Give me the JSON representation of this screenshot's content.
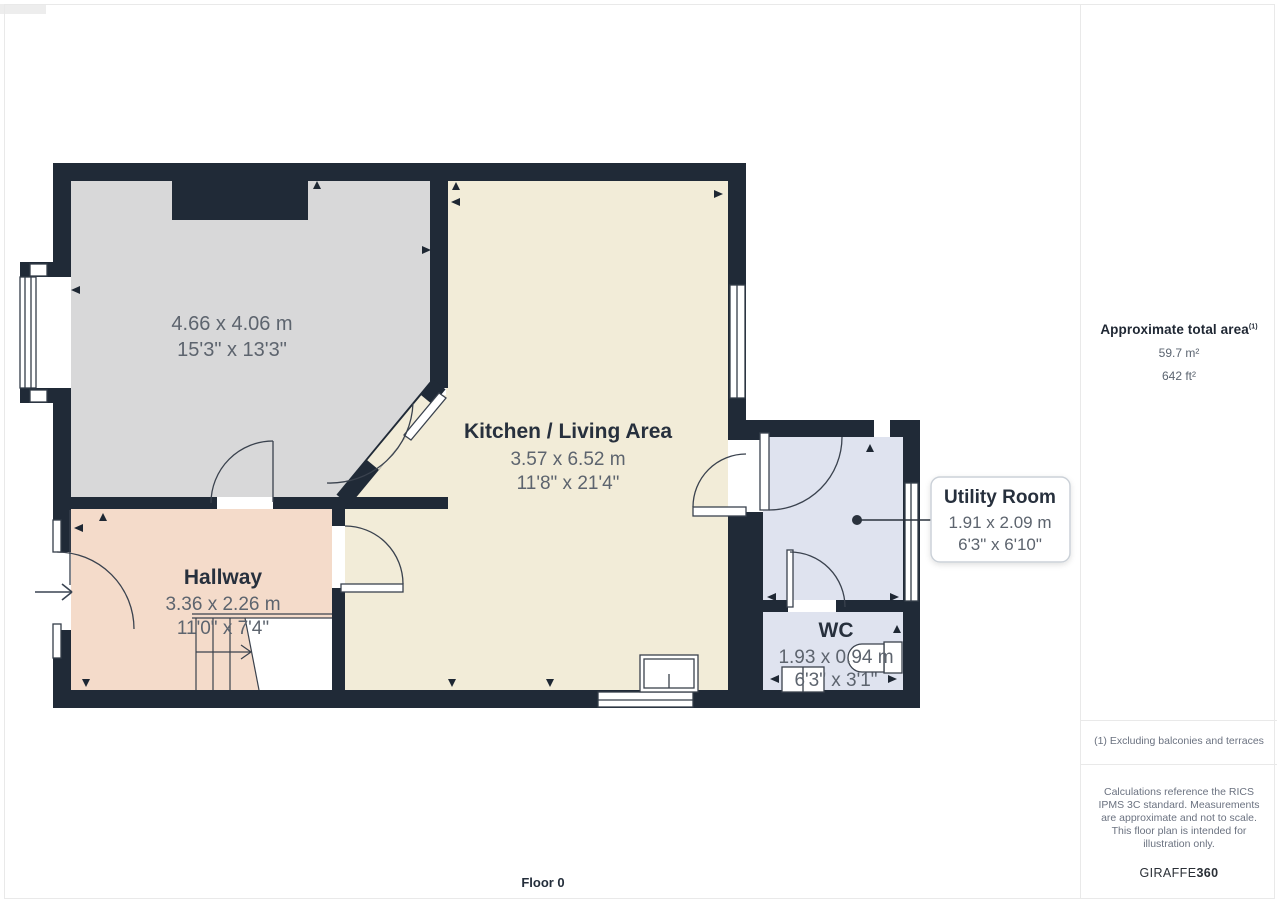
{
  "plan": {
    "floor_label": "Floor 0",
    "rooms": {
      "reception": {
        "dim_m": "4.66 x 4.06 m",
        "dim_imperial": "15'3\" x 13'3\""
      },
      "kitchen_living": {
        "name": "Kitchen / Living Area",
        "dim_m": "3.57 x 6.52 m",
        "dim_imperial": "11'8\" x 21'4\""
      },
      "hallway": {
        "name": "Hallway",
        "dim_m": "3.36 x 2.26 m",
        "dim_imperial": "11'0\" x 7'4\""
      },
      "utility": {
        "name": "Utility Room",
        "dim_m": "1.91 x 2.09 m",
        "dim_imperial": "6'3\" x 6'10\""
      },
      "wc": {
        "name": "WC",
        "dim_m": "1.93 x 0.94 m",
        "dim_imperial": "6'3\" x 3'1\""
      }
    }
  },
  "sidebar": {
    "total_area_label": "Approximate total area",
    "footnote_marker": "(1)",
    "area_metric": "59.7 m²",
    "area_imperial": "642 ft²",
    "footnote": "(1) Excluding balconies and terraces",
    "disclaimer": "Calculations reference the RICS IPMS 3C standard. Measurements are approximate and not to scale. This floor plan is intended for illustration only.",
    "brand_name": "GIRAFFE",
    "brand_suffix": "360"
  },
  "colors": {
    "wall": "#202a37",
    "room_gray": "#d8d8d9",
    "room_cream": "#f2ecd8",
    "room_peach": "#f4dbca",
    "room_blue": "#dfe3ef"
  }
}
